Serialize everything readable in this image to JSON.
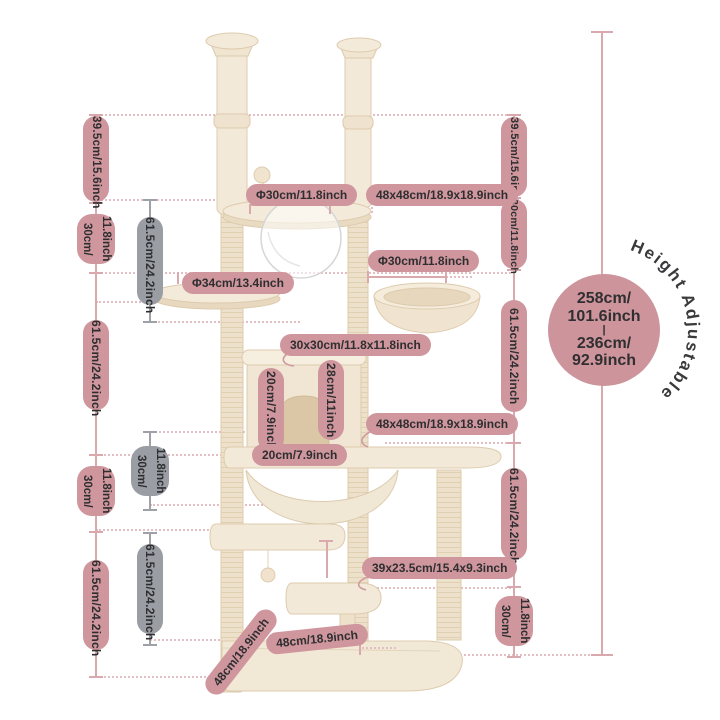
{
  "diagram": {
    "left_line": {
      "segments": [
        {
          "label": "39.5cm/15.6inch"
        },
        {
          "lines": [
            "30cm/",
            "11.8inch"
          ]
        },
        {
          "label": "61.5cm/24.2inch"
        },
        {
          "lines": [
            "30cm/",
            "11.8inch"
          ]
        },
        {
          "label": "61.5cm/24.2inch"
        }
      ]
    },
    "middle_line": {
      "segments": [
        {
          "label": "61.5cm/24.2inch"
        },
        {
          "lines": [
            "30cm/",
            "11.8inch"
          ]
        },
        {
          "label": "61.5cm/24.2inch"
        }
      ]
    },
    "right_line": {
      "segments": [
        {
          "label": "39.5cm/15.6inch"
        },
        {
          "label": "30cm/11.8inch"
        },
        {
          "label": "61.5cm/24.2inch"
        },
        {
          "label": "61.5cm/24.2inch"
        },
        {
          "lines": [
            "30cm/",
            "11.8inch"
          ]
        }
      ]
    },
    "part_labels": {
      "top_platform_diameter": "Φ30cm/11.8inch",
      "top_board_size": "48x48cm/18.9x18.9inch",
      "basket_diameter": "Φ30cm/11.8inch",
      "round_platform_diameter": "Φ34cm/13.4inch",
      "condo_size": "30x30cm/11.8x11.8inch",
      "condo_inner_height": "20cm/7.9inch",
      "condo_clearance": "28cm/11inch",
      "middle_board_size": "48x48cm/18.9x18.9inch",
      "board_depth": "20cm/7.9inch",
      "step_size": "39x23.5cm/15.4x9.3inch",
      "base_width": "48cm/18.9inch",
      "base_side": "48cm/18.9inch"
    },
    "height_badge": {
      "lines": [
        "258cm/",
        "101.6inch",
        "|",
        "236cm/",
        "92.9inch"
      ],
      "arc_label": "Height Adjustable"
    }
  },
  "colors": {
    "pill_pink": "#cf979d",
    "pill_gray": "#9a9da4",
    "line_pink": "#d9a9ae",
    "line_gray": "#9fa1a9",
    "dash_pink": "#e2bfc3",
    "badge_pink": "#cd949b",
    "tree_beige": "#f3e9d8",
    "text_dark": "#2e2e30"
  }
}
